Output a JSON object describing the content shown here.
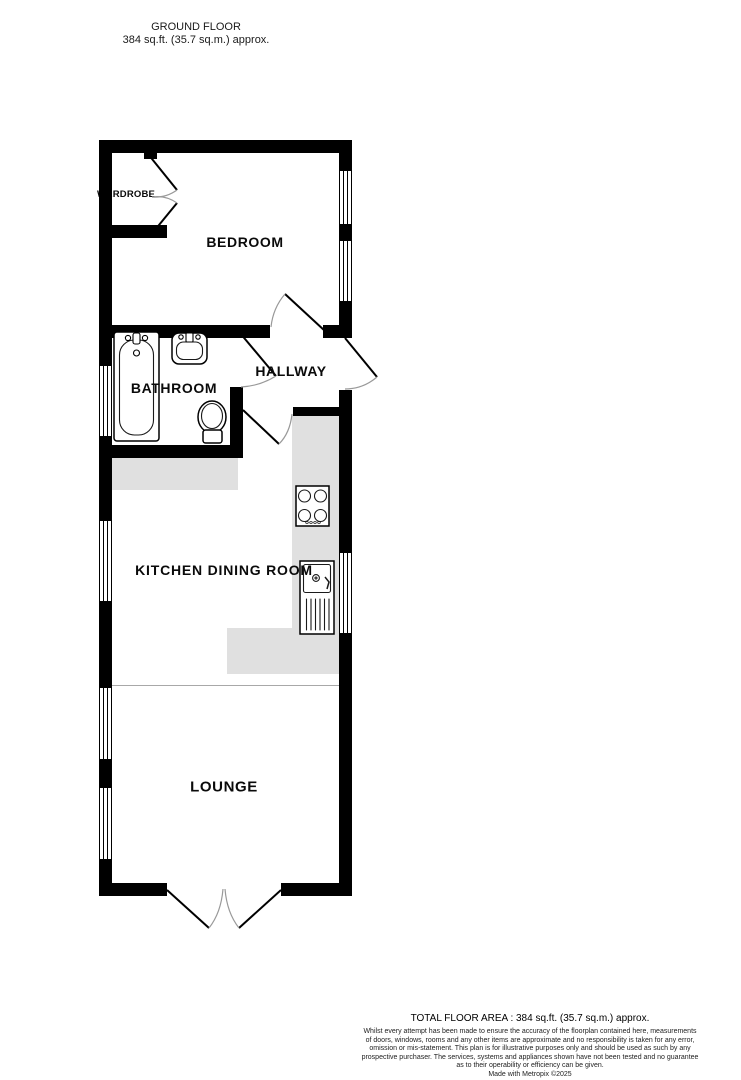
{
  "header": {
    "title": "GROUND FLOOR",
    "subtitle": "384 sq.ft. (35.7 sq.m.) approx."
  },
  "rooms": {
    "bedroom": "BEDROOM",
    "wardrobe": "WARDROBE",
    "bathroom": "BATHROOM",
    "hallway": "HALLWAY",
    "kitchen_dining": "KITCHEN DINING ROOM",
    "lounge": "LOUNGE"
  },
  "icons": {
    "bathtub-icon": "bathtub outline with taps",
    "washbasin-icon": "wash basin with taps",
    "toilet-icon": "toilet bowl with cistern",
    "hob-icon": "4-ring cooker hob",
    "sink-drainer-icon": "kitchen sink with drainer",
    "wardrobe-doors-icon": "double wardrobe door swing",
    "door-swing-icon": "door swing arc",
    "french-doors-icon": "outward opening double doors",
    "window-icon": "double-line window in wall"
  },
  "colors": {
    "wall": "#000000",
    "counter": "#e0e0e0",
    "window": "#ffffff",
    "door_arc": "#999999"
  },
  "footer": {
    "total": "TOTAL FLOOR AREA : 384 sq.ft. (35.7 sq.m.) approx.",
    "disclaimer_lines": [
      "Whilst every attempt has been made to ensure the accuracy of the floorplan contained here, measurements",
      "of doors, windows, rooms and any other items are approximate and no responsibility is taken for any error,",
      "omission or mis-statement. This plan is for illustrative purposes only and should be used as such by any",
      "prospective purchaser. The services, systems and appliances shown have not been tested and no guarantee",
      "as to their operability or efficiency can be given."
    ],
    "credit": "Made with Metropix ©2025"
  }
}
